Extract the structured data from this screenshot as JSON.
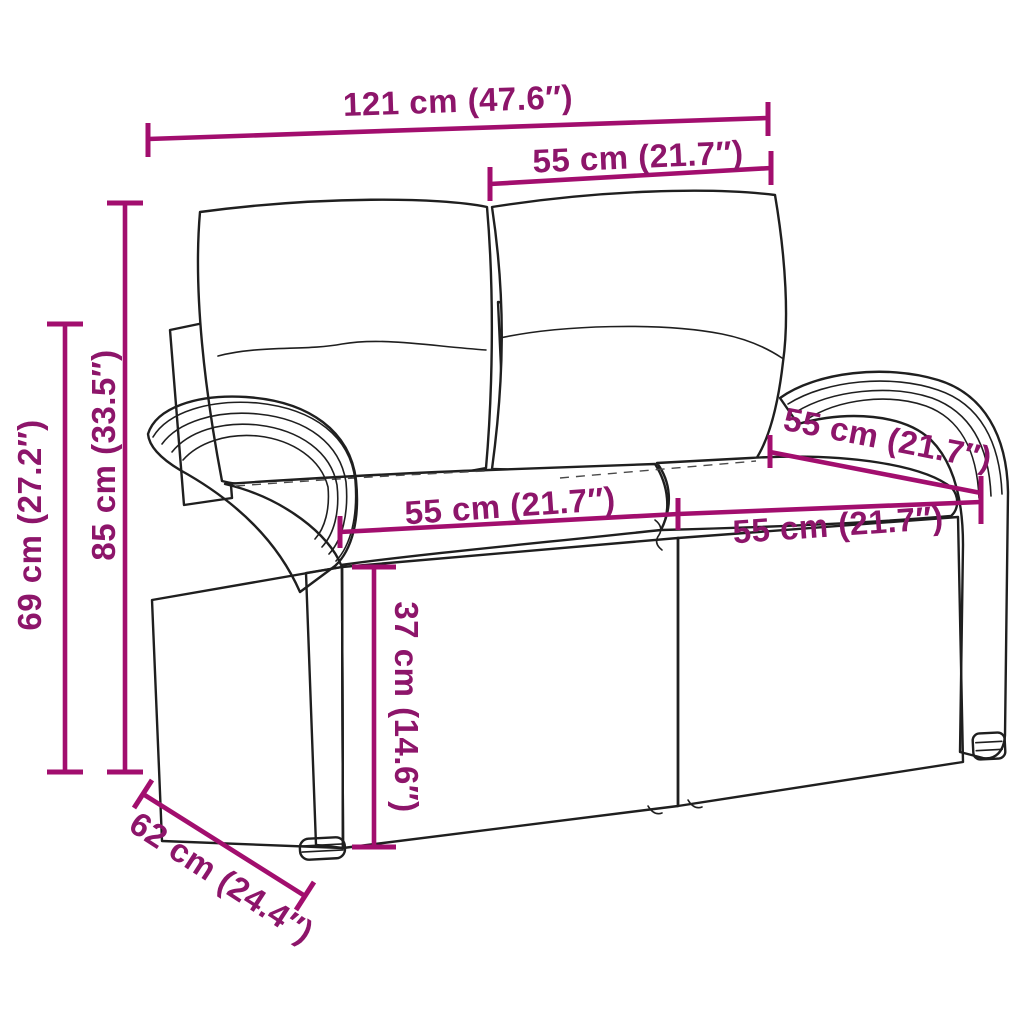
{
  "diagram": {
    "name": "rattan-garden-bench-dimension-diagram",
    "background_color": "#ffffff",
    "outline_color": "#1f1f1f",
    "accent_line_color": "#A20E6E",
    "accent_text_color": "#8D156A"
  },
  "dimensions": {
    "overall_width": {
      "label": "121 cm (47.6″)"
    },
    "back_section_width": {
      "label": "55 cm (21.7″)"
    },
    "overall_height": {
      "label": "85 cm (33.5″)"
    },
    "side_height": {
      "label": "69 cm (27.2″)"
    },
    "left_seat_width": {
      "label": "55 cm (21.7″)"
    },
    "right_seat_width": {
      "label": "55 cm (21.7″)"
    },
    "seat_depth": {
      "label": "55 cm (21.7″)"
    },
    "seat_height": {
      "label": "37 cm (14.6″)"
    },
    "overall_depth": {
      "label": "62 cm (24.4″)"
    }
  }
}
